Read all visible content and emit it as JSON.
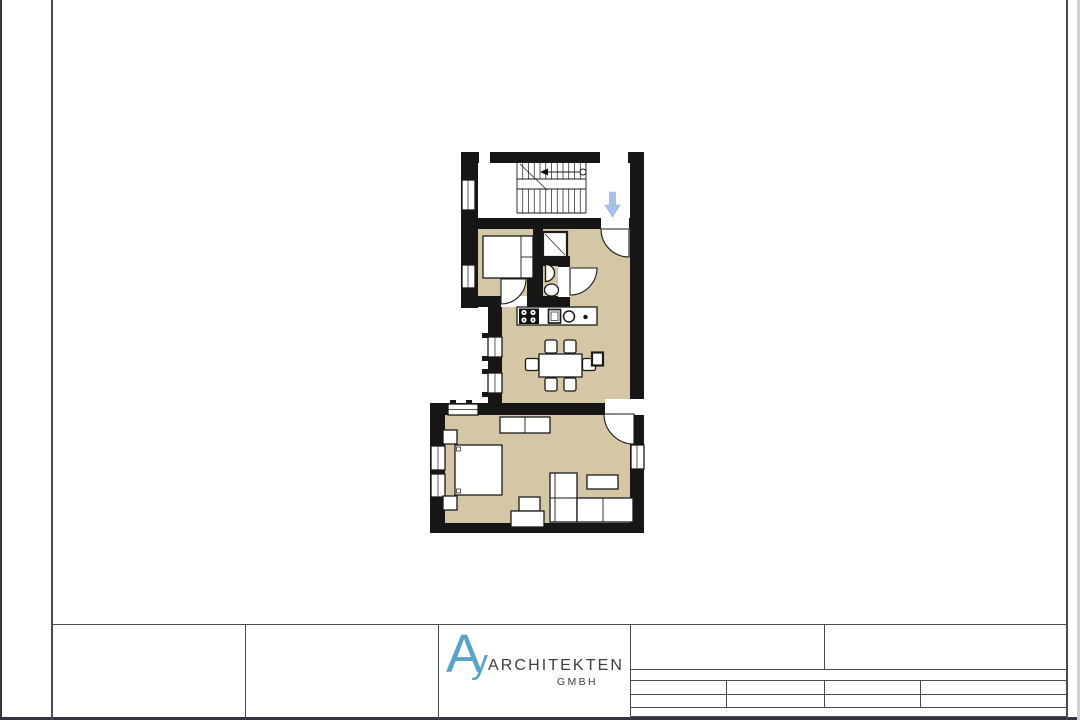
{
  "sheet": {
    "logo": {
      "mark_a": "A",
      "mark_y": "y",
      "company": "ARCHITEKTEN",
      "suffix": "GMBH"
    }
  },
  "icons": {
    "entrance_arrow": "down-arrow",
    "stair_direction": "arrow-with-start-circle"
  },
  "colors": {
    "paper": "#ffffff",
    "wall": "#161616",
    "floor": "#d5c7a5",
    "arrow": "#a7c2ea",
    "logo_blue": "#56a4cc",
    "line": "#4a4a52"
  }
}
